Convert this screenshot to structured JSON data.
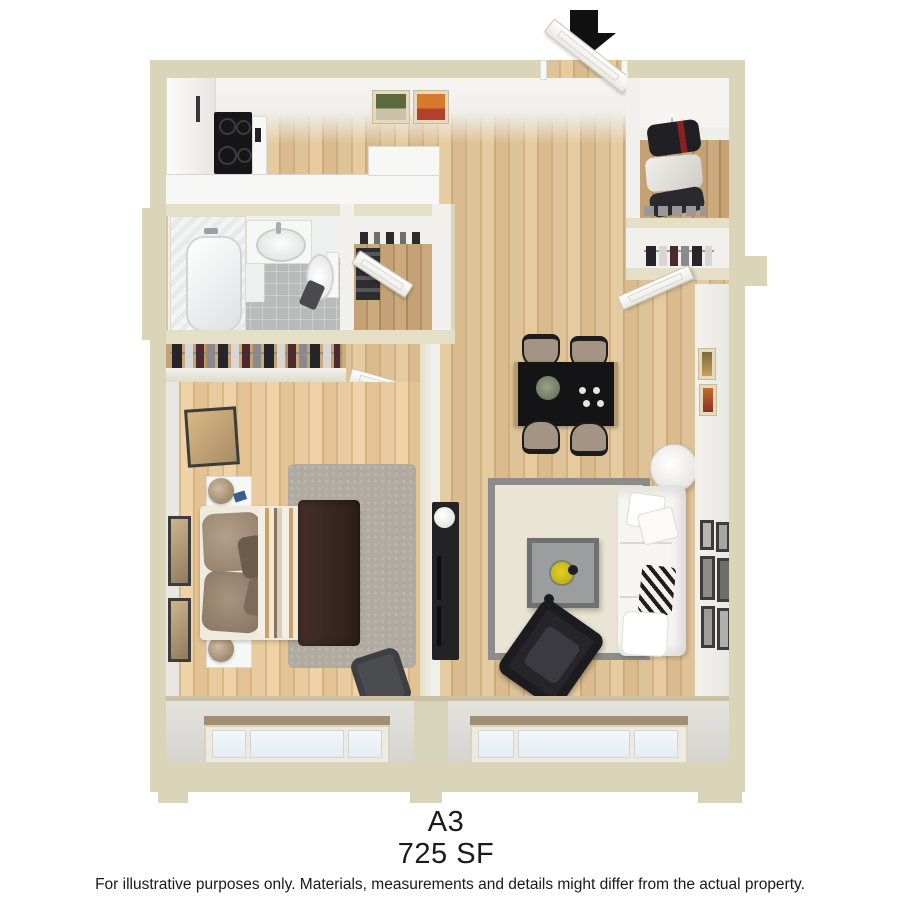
{
  "plan": {
    "name": "A3",
    "area": "725 SF",
    "disclaimer": "For illustrative purposes only.  Materials, measurements and details might differ from the actual property."
  },
  "colors": {
    "wall_exterior": "#dad5b8",
    "wall_exterior_light": "#e4dfc6",
    "wall_face": "#f1f0ec",
    "wood": "#dcbf93",
    "wood_closet": "#bd9c70",
    "tile_gray": "#b7bcba",
    "fixture_white": "#f7f7f5",
    "furniture_black": "#232325",
    "rug_living": "#e9e4d3",
    "rug_border": "#8c8c8a",
    "rug_bedroom": "#b1aaa0",
    "blanket_brown": "#3c2a24",
    "duvet_tan": "#c9a268",
    "accent_yellow": "#e2cf25",
    "glass_blue": "#e9f1f5",
    "entry_arrow": "#111111",
    "text": "#1a1a1a"
  },
  "scene": {
    "entry": {
      "marker": "entry-arrow",
      "doors": [
        "entry-door"
      ]
    },
    "rooms": [
      {
        "name": "kitchen",
        "contents": [
          "refrigerator-cabinet",
          "cooktop",
          "range",
          "l-counter",
          "wall-art"
        ]
      },
      {
        "name": "bathroom",
        "contents": [
          "bathtub",
          "vanity-sink",
          "toilet",
          "bath-mat"
        ]
      },
      {
        "name": "hall-closet",
        "contents": [
          "closet-door",
          "hanging-clothes",
          "shelf"
        ]
      },
      {
        "name": "bedroom-closet",
        "contents": [
          "hanging-clothes"
        ]
      },
      {
        "name": "bedroom",
        "contents": [
          "bed",
          "striped-duvet",
          "brown-blanket",
          "pillows",
          "nightstand",
          "nightstand",
          "table-lamp",
          "table-lamp",
          "leaning-mirror",
          "shag-rug",
          "accent-chair",
          "wall-art",
          "window"
        ]
      },
      {
        "name": "living-dining",
        "contents": [
          "dining-table",
          "dining-chair",
          "dining-chair",
          "dining-chair",
          "dining-chair",
          "centerpiece",
          "sofa",
          "throw-pillows",
          "coffee-table",
          "flowers",
          "lounge-chair",
          "media-console",
          "floor-lamp",
          "area-rug",
          "gallery-frames",
          "window"
        ]
      },
      {
        "name": "entry-closet-upper",
        "contents": [
          "hanging-clothes",
          "shoes"
        ]
      },
      {
        "name": "entry-closet-lower",
        "contents": [
          "hanging-clothes",
          "closet-door"
        ]
      }
    ]
  }
}
